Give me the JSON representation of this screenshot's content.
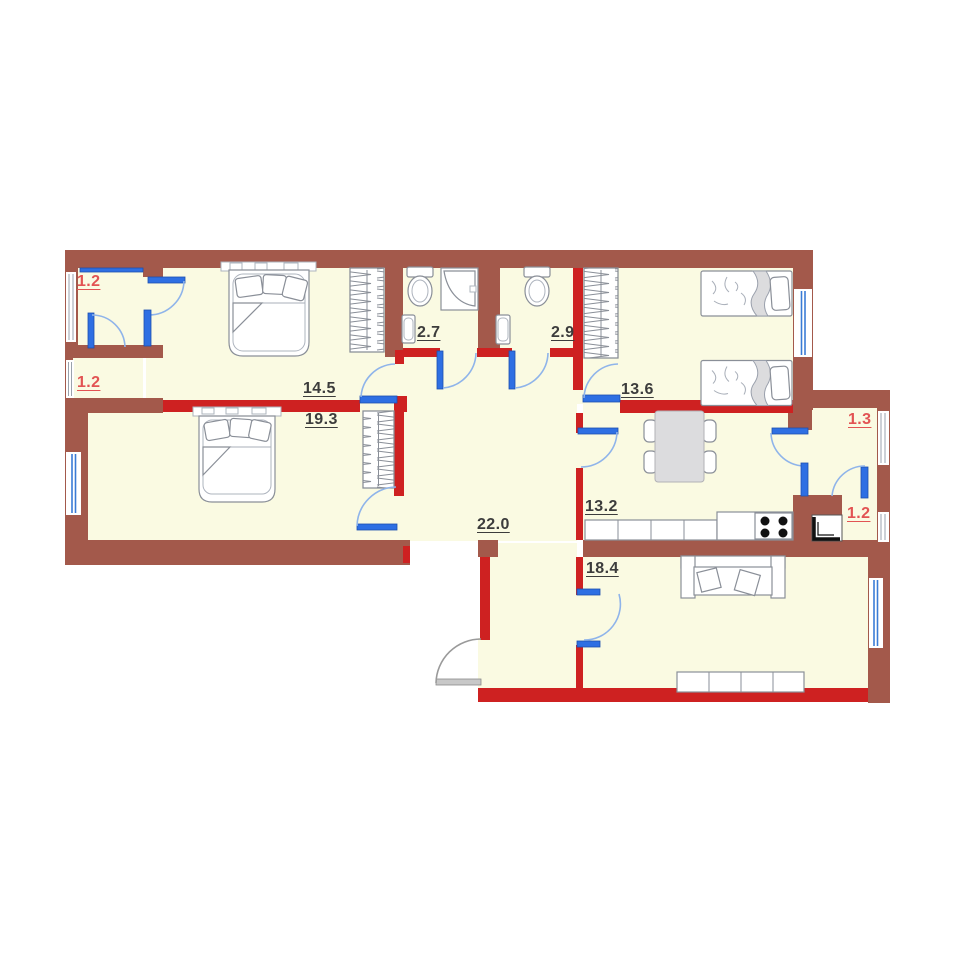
{
  "plan": {
    "type": "apartment-floor-plan",
    "colors": {
      "floor": "#FAFAE2",
      "wall_exterior": "#A3594B",
      "wall_interior": "#CE2121",
      "door": "#2E6FE3",
      "door_arc": "#8FB4EA",
      "window_glass": "#3A7BD5",
      "entry_door": "#9A9A9A",
      "label_dark": "#3C3C3C",
      "label_red": "#E25353"
    },
    "rooms": {
      "loggia_top_left": {
        "area": "1.2",
        "style": "red"
      },
      "loggia_bottom_left": {
        "area": "1.2",
        "style": "red"
      },
      "bedroom_main": {
        "area": "14.5",
        "style": "dark"
      },
      "bedroom_left": {
        "area": "19.3",
        "style": "dark"
      },
      "bathroom_first": {
        "area": "2.7",
        "style": "dark"
      },
      "bathroom_second": {
        "area": "2.9",
        "style": "dark"
      },
      "bedroom_kids": {
        "area": "13.6",
        "style": "dark"
      },
      "kitchen": {
        "area": "13.2",
        "style": "dark"
      },
      "corridor": {
        "area": "22.0",
        "style": "dark"
      },
      "living_room": {
        "area": "18.4",
        "style": "dark"
      },
      "loggia_right_top": {
        "area": "1.3",
        "style": "red"
      },
      "loggia_right_bottom": {
        "area": "1.2",
        "style": "red"
      }
    },
    "icons": [
      "double-bed-icon",
      "single-bed-icon",
      "wardrobe-icon",
      "toilet-icon",
      "shower-icon",
      "sink-icon",
      "dining-table-icon",
      "chair-icon",
      "kitchen-counter-icon",
      "stove-icon",
      "fridge-icon",
      "sofa-icon",
      "sideboard-icon",
      "door-swing-icon",
      "window-icon",
      "entry-door-icon"
    ]
  }
}
